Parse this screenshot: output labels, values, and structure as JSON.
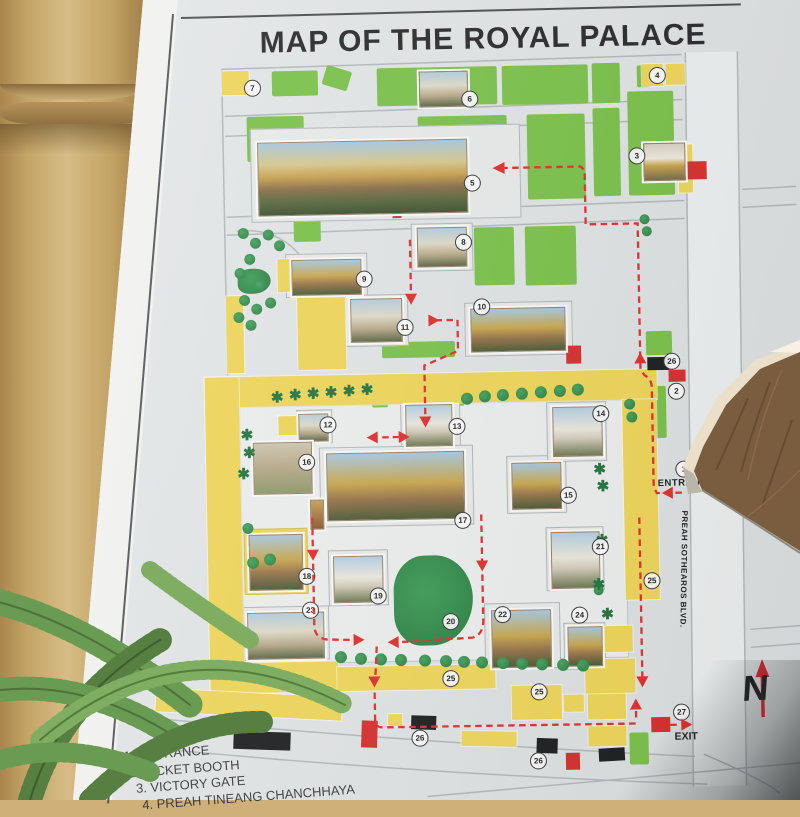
{
  "board": {
    "title": "MAP OF THE ROYAL PALACE",
    "street_label": "PREAH SOTHEAROS BLVD.",
    "entrance_label": "ENTRANCE",
    "exit_label": "EXIT",
    "compass_label": "N",
    "legend_items": [
      "1. ENTRANCE",
      "2. TICKET BOOTH",
      "3. VICTORY GATE",
      "4. PREAH TINEANG CHANCHHAYA"
    ]
  },
  "colors": {
    "lawn_green": "#7cc34b",
    "tree_green": "#2c7d43",
    "building_yellow": "#f0d75a",
    "gate_red": "#d7312e",
    "route_red": "#e0312e",
    "gate_black": "#1e1f20",
    "board_gray": "#e2e5e6",
    "wall_tan": "#c8a96d",
    "cardboard_brown": "#7a5c3e",
    "torn_paper_cream": "#eadfc8"
  },
  "map": {
    "markers": [
      {
        "n": "7",
        "x": 258,
        "y": 85
      },
      {
        "n": "4",
        "x": 663,
        "y": 80
      },
      {
        "n": "6",
        "x": 475,
        "y": 100
      },
      {
        "n": "3",
        "x": 641,
        "y": 160
      },
      {
        "n": "5",
        "x": 476,
        "y": 184
      },
      {
        "n": "8",
        "x": 466,
        "y": 243
      },
      {
        "n": "9",
        "x": 366,
        "y": 278
      },
      {
        "n": "10",
        "x": 483,
        "y": 308
      },
      {
        "n": "11",
        "x": 406,
        "y": 327
      },
      {
        "n": "26",
        "x": 672,
        "y": 366
      },
      {
        "n": "2",
        "x": 676,
        "y": 396
      },
      {
        "n": "14",
        "x": 600,
        "y": 417
      },
      {
        "n": "12",
        "x": 327,
        "y": 423
      },
      {
        "n": "13",
        "x": 456,
        "y": 427
      },
      {
        "n": "16",
        "x": 305,
        "y": 460
      },
      {
        "n": "1",
        "x": 682,
        "y": 474
      },
      {
        "n": "15",
        "x": 566,
        "y": 498
      },
      {
        "n": "17",
        "x": 460,
        "y": 521
      },
      {
        "n": "21",
        "x": 597,
        "y": 550
      },
      {
        "n": "18",
        "x": 303,
        "y": 574
      },
      {
        "n": "25",
        "x": 648,
        "y": 585
      },
      {
        "n": "19",
        "x": 374,
        "y": 595
      },
      {
        "n": "23",
        "x": 306,
        "y": 608
      },
      {
        "n": "22",
        "x": 498,
        "y": 616
      },
      {
        "n": "24",
        "x": 575,
        "y": 618
      },
      {
        "n": "20",
        "x": 446,
        "y": 622
      },
      {
        "n": "25",
        "x": 445,
        "y": 679
      },
      {
        "n": "25",
        "x": 533,
        "y": 694
      },
      {
        "n": "27",
        "x": 675,
        "y": 717
      },
      {
        "n": "26",
        "x": 413,
        "y": 738
      },
      {
        "n": "26",
        "x": 531,
        "y": 763
      }
    ],
    "lawns": [
      [
        278,
        69,
        46,
        25,
        0
      ],
      [
        330,
        67,
        26,
        20,
        18
      ],
      [
        383,
        68,
        120,
        38,
        0
      ],
      [
        508,
        68,
        86,
        39,
        0
      ],
      [
        598,
        67,
        28,
        40,
        0
      ],
      [
        643,
        70,
        13,
        22,
        0
      ],
      [
        252,
        114,
        57,
        45,
        0
      ],
      [
        423,
        117,
        89,
        21,
        0
      ],
      [
        532,
        117,
        58,
        85,
        0
      ],
      [
        598,
        112,
        27,
        88,
        0
      ],
      [
        633,
        96,
        46,
        104,
        0
      ],
      [
        297,
        212,
        27,
        28,
        0
      ],
      [
        477,
        229,
        40,
        58,
        0
      ],
      [
        528,
        229,
        51,
        59,
        0
      ],
      [
        383,
        342,
        73,
        16,
        0
      ],
      [
        647,
        336,
        26,
        24,
        0
      ],
      [
        633,
        389,
        15,
        52,
        0
      ],
      [
        654,
        391,
        12,
        52,
        0
      ],
      [
        623,
        737,
        19,
        32,
        0
      ],
      [
        640,
        535,
        14,
        38,
        0
      ],
      [
        372,
        396,
        16,
        11,
        0
      ],
      [
        448,
        396,
        16,
        11,
        0
      ]
    ],
    "blobs": [
      [
        240,
        266,
        33,
        25
      ],
      [
        390,
        556,
        79,
        90
      ]
    ],
    "trees": [
      [
        246,
        230,
        11
      ],
      [
        258,
        240,
        11
      ],
      [
        271,
        232,
        11
      ],
      [
        282,
        243,
        11
      ],
      [
        252,
        256,
        11
      ],
      [
        242,
        270,
        11
      ],
      [
        262,
        283,
        11
      ],
      [
        246,
        297,
        11
      ],
      [
        258,
        306,
        11
      ],
      [
        272,
        300,
        11
      ],
      [
        240,
        314,
        11
      ],
      [
        252,
        322,
        11
      ],
      [
        648,
        224,
        10
      ],
      [
        650,
        236,
        10
      ],
      [
        629,
        408,
        11
      ],
      [
        631,
        421,
        11
      ],
      [
        336,
        656,
        12
      ],
      [
        356,
        658,
        12
      ],
      [
        376,
        659,
        12
      ],
      [
        396,
        660,
        12
      ],
      [
        420,
        661,
        12
      ],
      [
        441,
        662,
        12
      ],
      [
        459,
        663,
        12
      ],
      [
        477,
        664,
        12
      ],
      [
        498,
        665,
        12
      ],
      [
        517,
        666,
        12
      ],
      [
        537,
        667,
        12
      ],
      [
        558,
        668,
        12
      ],
      [
        578,
        669,
        12
      ],
      [
        250,
        560,
        12
      ],
      [
        267,
        557,
        12
      ],
      [
        467,
        400,
        12
      ],
      [
        485,
        398,
        12
      ],
      [
        503,
        397,
        12
      ],
      [
        522,
        396,
        12
      ],
      [
        541,
        395,
        12
      ],
      [
        560,
        394,
        12
      ],
      [
        578,
        393,
        12
      ],
      [
        595,
        594,
        10
      ],
      [
        245,
        525,
        11
      ]
    ],
    "palms": [
      [
        278,
        397
      ],
      [
        296,
        395
      ],
      [
        314,
        394
      ],
      [
        332,
        393
      ],
      [
        350,
        392
      ],
      [
        368,
        391
      ],
      [
        247,
        434
      ],
      [
        249,
        452
      ],
      [
        243,
        473
      ],
      [
        599,
        475
      ],
      [
        602,
        492
      ],
      [
        600,
        546
      ],
      [
        596,
        590
      ],
      [
        604,
        620
      ]
    ],
    "yellow_blocks": [
      [
        205,
        374,
        452,
        30,
        0
      ],
      [
        205,
        374,
        34,
        318,
        0
      ],
      [
        622,
        404,
        34,
        200,
        0
      ],
      [
        205,
        660,
        128,
        30,
        0
      ],
      [
        332,
        666,
        158,
        24,
        0
      ],
      [
        506,
        688,
        50,
        34,
        0
      ],
      [
        558,
        698,
        20,
        17,
        0
      ],
      [
        582,
        697,
        38,
        26,
        0
      ],
      [
        582,
        630,
        46,
        26,
        0
      ],
      [
        580,
        663,
        50,
        34,
        0
      ],
      [
        582,
        730,
        38,
        20,
        0
      ],
      [
        455,
        733,
        55,
        15,
        2
      ],
      [
        150,
        690,
        186,
        23,
        4
      ],
      [
        228,
        68,
        27,
        24,
        0
      ],
      [
        648,
        69,
        21,
        22,
        0
      ],
      [
        672,
        69,
        19,
        21,
        0
      ],
      [
        683,
        150,
        14,
        48,
        0
      ],
      [
        280,
        257,
        23,
        33,
        0
      ],
      [
        299,
        296,
        48,
        72,
        0
      ],
      [
        228,
        293,
        17,
        77,
        0
      ],
      [
        278,
        414,
        22,
        19,
        0
      ],
      [
        382,
        714,
        14,
        12,
        0
      ]
    ],
    "black_blocks": [
      [
        648,
        362,
        22,
        13,
        0
      ],
      [
        405,
        716,
        25,
        14,
        3
      ],
      [
        530,
        741,
        21,
        15,
        3
      ],
      [
        592,
        752,
        26,
        13,
        -2
      ],
      [
        227,
        729,
        57,
        18,
        3
      ]
    ],
    "red_blocks": [
      [
        684,
        167,
        27,
        18,
        0
      ],
      [
        669,
        375,
        17,
        12,
        0
      ],
      [
        645,
        722,
        19,
        15,
        0
      ],
      [
        355,
        720,
        16,
        27,
        3
      ],
      [
        559,
        756,
        14,
        17,
        0
      ],
      [
        567,
        349,
        15,
        18,
        0
      ],
      [
        396,
        196,
        9,
        22,
        0
      ],
      [
        370,
        206,
        58,
        5,
        0
      ]
    ],
    "plans": [
      [
        255,
        126,
        268,
        92
      ],
      [
        414,
        224,
        60,
        46
      ],
      [
        288,
        252,
        80,
        42
      ],
      [
        346,
        294,
        62,
        50
      ],
      [
        466,
        304,
        106,
        52
      ],
      [
        400,
        400,
        58,
        50
      ],
      [
        318,
        446,
        152,
        78
      ],
      [
        505,
        458,
        58,
        56
      ],
      [
        325,
        549,
        58,
        54
      ],
      [
        480,
        605,
        74,
        64
      ],
      [
        239,
        604,
        84,
        52
      ],
      [
        559,
        626,
        40,
        45
      ],
      [
        543,
        530,
        56,
        62
      ],
      [
        546,
        405,
        58,
        58
      ],
      [
        296,
        408,
        34,
        32
      ]
    ],
    "mats": [
      [
        241,
        526,
        62,
        64
      ]
    ],
    "photos": [
      [
        262,
        140,
        208,
        72,
        "palace"
      ],
      [
        425,
        72,
        47,
        34,
        "bldg"
      ],
      [
        648,
        148,
        40,
        36,
        "gate"
      ],
      [
        420,
        228,
        48,
        38,
        "bldg"
      ],
      [
        294,
        258,
        68,
        34,
        "wat"
      ],
      [
        352,
        298,
        50,
        42,
        "bldg"
      ],
      [
        472,
        310,
        93,
        42,
        "wat"
      ],
      [
        298,
        412,
        28,
        26,
        "bldg"
      ],
      [
        405,
        405,
        45,
        40,
        "stupa"
      ],
      [
        552,
        410,
        48,
        48,
        "stupa"
      ],
      [
        252,
        440,
        57,
        50,
        "mural"
      ],
      [
        325,
        452,
        136,
        66,
        "wat"
      ],
      [
        510,
        465,
        48,
        45,
        "wat"
      ],
      [
        246,
        532,
        52,
        54,
        "wat"
      ],
      [
        330,
        555,
        48,
        45,
        "stupa"
      ],
      [
        404,
        580,
        44,
        46,
        "stupa"
      ],
      [
        548,
        535,
        47,
        55,
        "stupa"
      ],
      [
        487,
        612,
        58,
        56,
        "wat"
      ],
      [
        243,
        610,
        75,
        45,
        "bldg"
      ],
      [
        563,
        630,
        33,
        38,
        "wat"
      ],
      [
        308,
        498,
        12,
        28,
        "spire"
      ]
    ]
  }
}
